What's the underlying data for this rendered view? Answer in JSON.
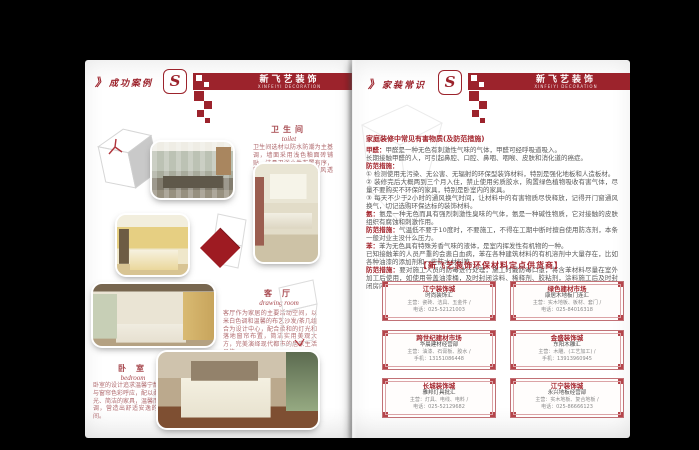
{
  "brand": {
    "logo_letter": "S",
    "name_cn": "新飞艺装饰",
    "name_en": "XINFEIYI DECORATION",
    "accent_red": "#9c232c"
  },
  "left_page": {
    "marker": "》",
    "title": "成功案例",
    "rooms": {
      "toilet": {
        "cn": "卫生间",
        "en": "toilet",
        "desc": "卫生间选材以防水防潮为主基调，墙面采用浅色釉面砖铺贴，洁具卫浴小件布置有序，整体搭配干净明亮，通风透气。"
      },
      "living": {
        "cn": "客 厅",
        "en": "drawing room",
        "desc": "客厅作为家居的主要活动空间，以米白色调和温馨的布艺沙发/茶几组合为设计中心，配合柔和的灯光和落地窗帘布置，简洁实用美观大方，完美演绎现代都市的居家生活品位。"
      },
      "bedroom": {
        "cn": "卧 室",
        "en": "bedroom",
        "desc": "卧室的设计追求温馨宁静，床品与窗帘色彩呼应，配以柔和的灯光、简洁的家具，温馨而富有情调，营造出舒适安逸的休憩空间。"
      }
    }
  },
  "right_page": {
    "marker": "》",
    "title": "家装常识",
    "article": {
      "title": "家庭装修中常见有害物质(及防范措施)",
      "lines": [
        {
          "lead": "甲醛：",
          "text": "甲醛是一种无色有刺激性气味的气体，甲醛可经呼吸道吸入。"
        },
        {
          "lead": "",
          "text": "长期接触甲醛的人，可引起鼻腔、口腔、鼻咽、咽喉、皮肤和消化道的癌症。"
        },
        {
          "lead": "防范措施：",
          "text": ""
        },
        {
          "lead": "",
          "text": "① 检测使用无污染、无公害、无辐射的环保型装饰材料，特别是强化地板和人造板材。"
        },
        {
          "lead": "",
          "text": "② 装修完后大概两到三个月入住，禁止使用劣质胶水，购置绿色植物吸收有害气体，尽量不要购买不环保的家具，特别是卧室内的家具。"
        },
        {
          "lead": "",
          "text": "③ 每天不少于2小时的通风换气时间，让材料中的有害物质尽快释放，记得开门窗通风换气，切记选购环保达标的装饰材料。"
        },
        {
          "lead": "氨：",
          "text": "氨是一种无色而具有强烈刺激性臭味的气体，氨是一种碱性物质，它对接触的皮肤组织有腐蚀和刺激作用。"
        },
        {
          "lead": "防范措施：",
          "text": "气温低不要于10度时，不要施工，不得在工期中断时擅自使用防冻剂，本条一般对业主没什么压力。"
        },
        {
          "lead": "苯：",
          "text": "苯为无色具有特殊芳香气味的液体，是室内挥发性有机物的一种。"
        },
        {
          "lead": "",
          "text": "已知接触苯的人员严重的会患白血病，苯在各种建筑材料的有机溶剂中大量存在，比如各种油漆的添加剂和一些防水材料等。"
        },
        {
          "lead": "防范措施：",
          "text": "要对施工人员的防毒进行处理，施工时戴防毒口罩，将含苯材料尽量在室外加工后使用，如使用带盖油漆桶，及时封闭涂料、稀释剂、胶粘剂，涂料施工后及时封闭房内并且保持室内通风。"
        }
      ]
    },
    "suppliers_heading": "【新飞艺装饰环保材料定点供货商】",
    "suppliers": [
      {
        "market": "江宁装饰城",
        "shop": "时尚装饰汇",
        "line1": "主营：瓷砖、洁具、五金件 /",
        "line2": "电话：025-52121003"
      },
      {
        "market": "绿色建材市场",
        "shop": "康居木地板门连汇",
        "line1": "主营：实木地板、板材、套门 /",
        "line2": "电话：025-84016318"
      },
      {
        "market": "跨世纪建材市场",
        "shop": "华晨建材经营部",
        "line1": "主营：油漆、石膏板、胶水 /",
        "line2": "手机：13151086448"
      },
      {
        "market": "金盛装饰城",
        "shop": "东阳木雕汇",
        "line1": "主营：木雕、(工艺加工) /",
        "line2": "手机：13913960945"
      },
      {
        "market": "长城装饰城",
        "shop": "雅邦灯具批汇",
        "line1": "主营：灯具、电线、电料 /",
        "line2": "电话：025-52129682"
      },
      {
        "market": "江宁装饰城",
        "shop": "永兴地板经营部",
        "line1": "主营：实木地板、复合地板 /",
        "line2": "电话：025-86666123"
      }
    ]
  }
}
